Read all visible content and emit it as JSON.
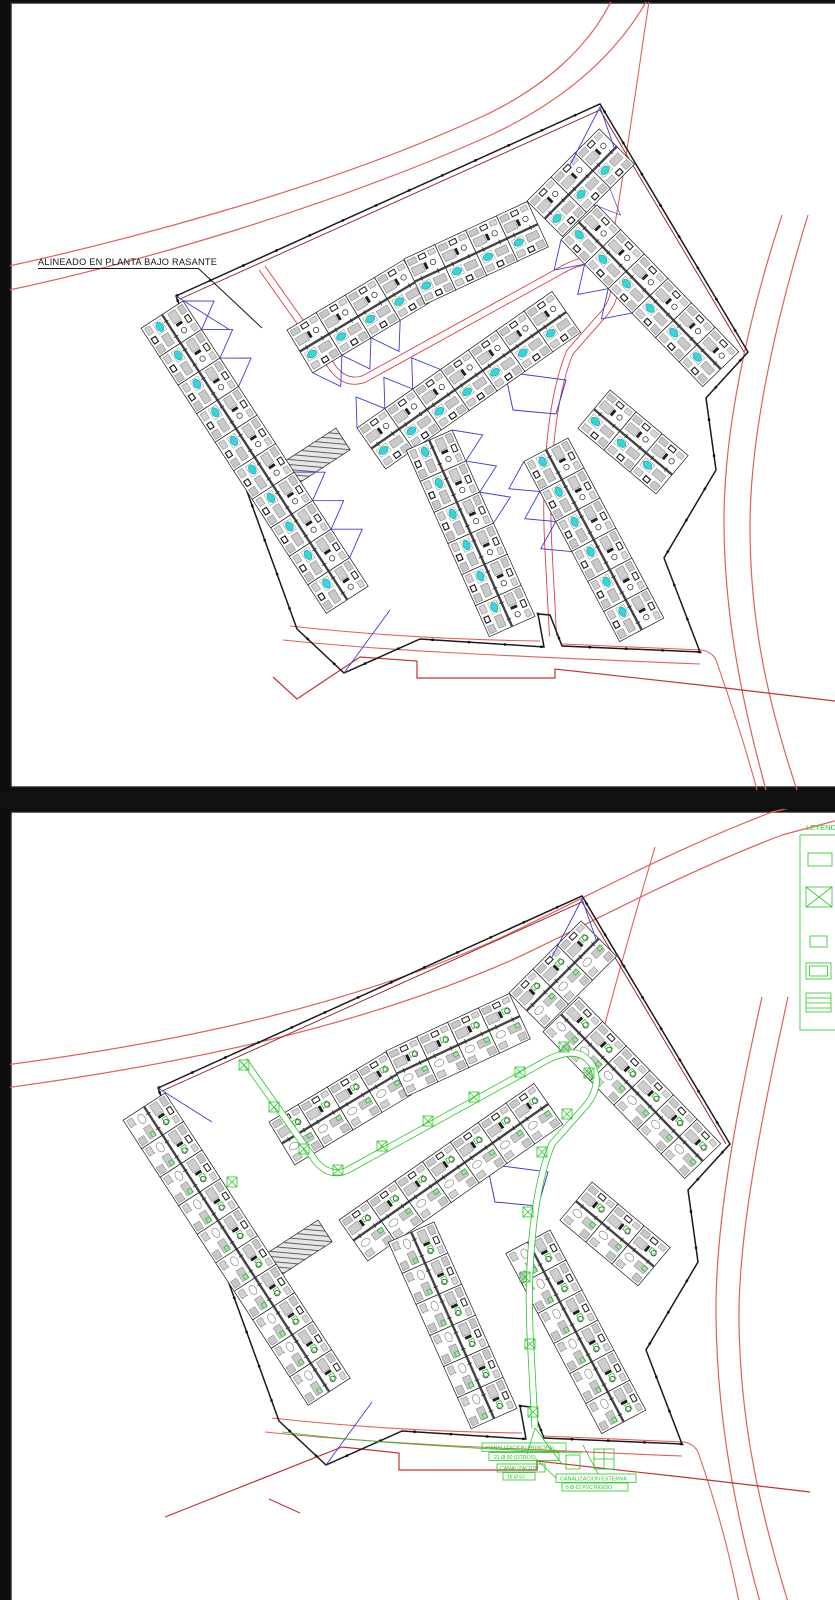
{
  "page": {
    "type": "CAD residential site plan, two stacked drawing sheets",
    "background": "#0e0e0e",
    "sheet_color": "#ffffff"
  },
  "top_panel": {
    "annotation": "ALINEADO EN PLANTA BAJO RASANTE"
  },
  "bottom_panel": {
    "legend": {
      "title": "LEYENDA",
      "items": [
        {
          "symbol": "parcel-outline-box"
        },
        {
          "symbol": "crossed-box"
        },
        {
          "symbol": "small-box"
        },
        {
          "symbol": "nested-box"
        },
        {
          "symbol": "hatched-box"
        }
      ]
    },
    "canalization_labels": [
      {
        "line1": "CANALIZACION PRINCIPAL",
        "line2": "21 Ø 50 (OTROS)"
      },
      {
        "line1": "CANALIZACION",
        "line2": "16 Ø 63"
      },
      {
        "line1": "CANALIZACION EXTERNA",
        "line2": "8 Ø 63 PVC RIGIDO"
      }
    ]
  },
  "colors": {
    "road_red": "#e0605c",
    "road_red_dark": "#c23434",
    "boundary_black": "#1a1a1a",
    "boundary_red": "#8f1f1f",
    "pool_cyan": "#35d6da",
    "roof_blue": "#3c3cd8",
    "utility_green": "#25c825",
    "detail_gray": "#c9c9c9"
  }
}
